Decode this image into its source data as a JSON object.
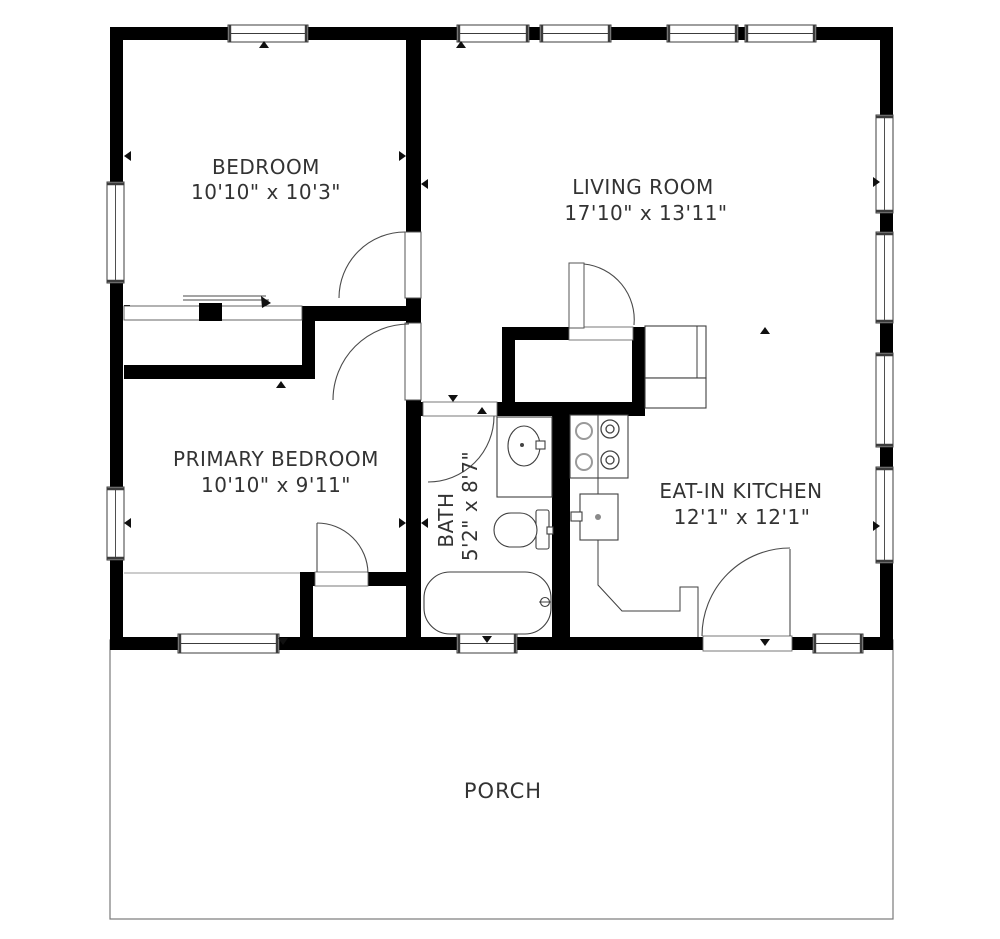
{
  "title": "2-bedroom house floor plan",
  "rooms": {
    "bedroom": {
      "name": "BEDROOM",
      "dims": "10'10\" x 10'3\""
    },
    "living_room": {
      "name": "LIVING ROOM",
      "dims": "17'10\" x 13'11\""
    },
    "primary_bedroom": {
      "name": "PRIMARY BEDROOM",
      "dims": "10'10\" x 9'11\""
    },
    "bath": {
      "name": "BATH",
      "dims": "5'2\" x 8'7\""
    },
    "eat_in_kitchen": {
      "name": "EAT-IN KITCHEN",
      "dims": "12'1\" x 12'1\""
    },
    "porch": {
      "name": "PORCH"
    }
  },
  "fixtures": [
    "sliding-door-closet",
    "closet-shelf-rod",
    "bathroom-sink",
    "toilet",
    "bathtub",
    "stove",
    "kitchen-sink",
    "kitchen-counter",
    "refrigerator"
  ],
  "colors": {
    "wall": "#000000",
    "background": "#ffffff",
    "line": "#3c3c3c",
    "text": "#333333"
  }
}
